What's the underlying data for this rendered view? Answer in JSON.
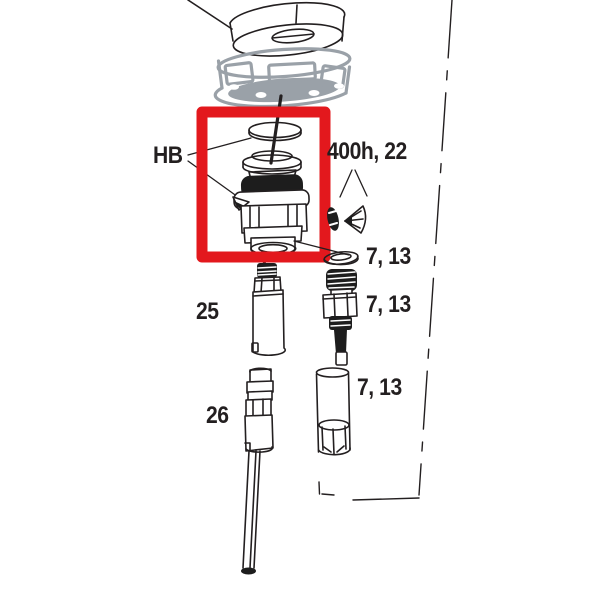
{
  "diagram": {
    "kind": "exploded-parts-diagram",
    "background_color": "#ffffff",
    "line_color": "#231f20",
    "gray_part_color": "#9aa1a8",
    "highlight_color": "#e3181d"
  },
  "callouts": {
    "hb": "HB",
    "service_400h": "400h, 22",
    "ref_7_13_washer": "7, 13",
    "ref_7_13_bolt": "7, 13",
    "ref_7_13_sleeve": "7, 13",
    "ref_25": "25",
    "ref_26": "26"
  }
}
